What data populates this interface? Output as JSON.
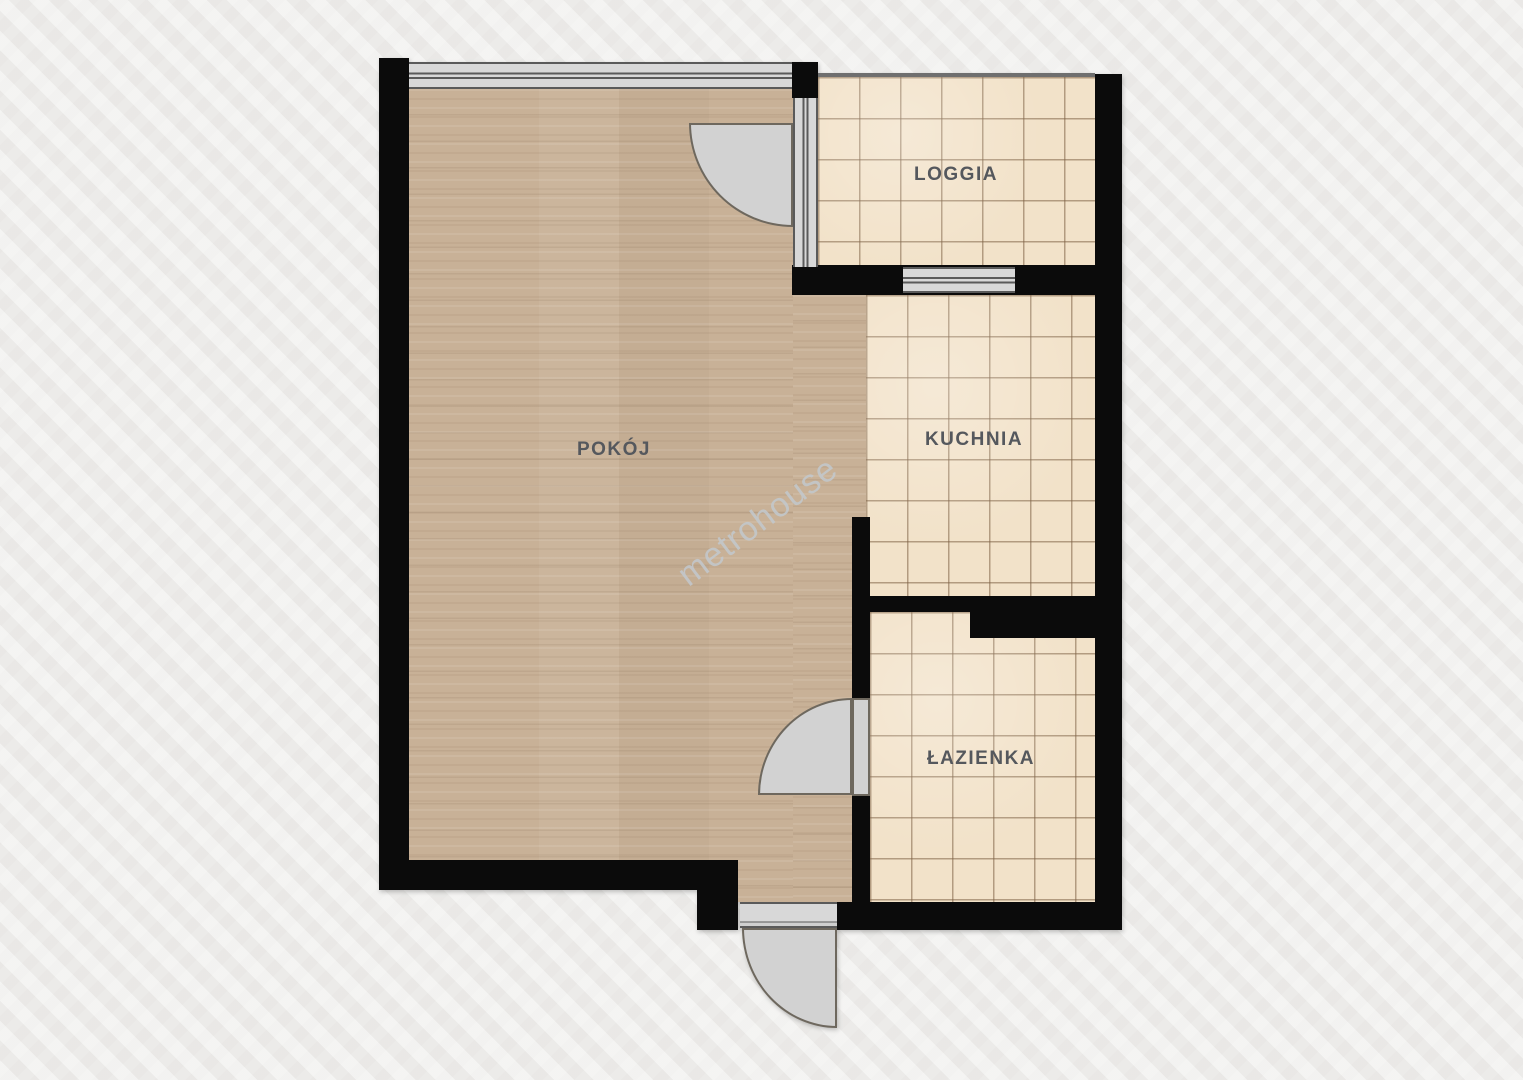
{
  "watermark": "metrohouse",
  "rooms": {
    "pokoj": {
      "label": "POKÓJ"
    },
    "loggia": {
      "label": "LOGGIA"
    },
    "kuchnia": {
      "label": "KUCHNIA"
    },
    "lazienka": {
      "label": "ŁAZIENKA"
    }
  },
  "colors": {
    "background": "#efeeec",
    "wall": "#0b0b0b",
    "wood_floor": "#c8b197",
    "tile_floor": "#f2e2c9",
    "tile_grout": "#8d7357",
    "window_glass": "#d8d8d8",
    "window_frame": "#5a5a5a",
    "door_fill": "#d2d2d2",
    "door_outline": "#6e685e",
    "label_text": "#55585d",
    "watermark_text": "#c3c9ce"
  }
}
